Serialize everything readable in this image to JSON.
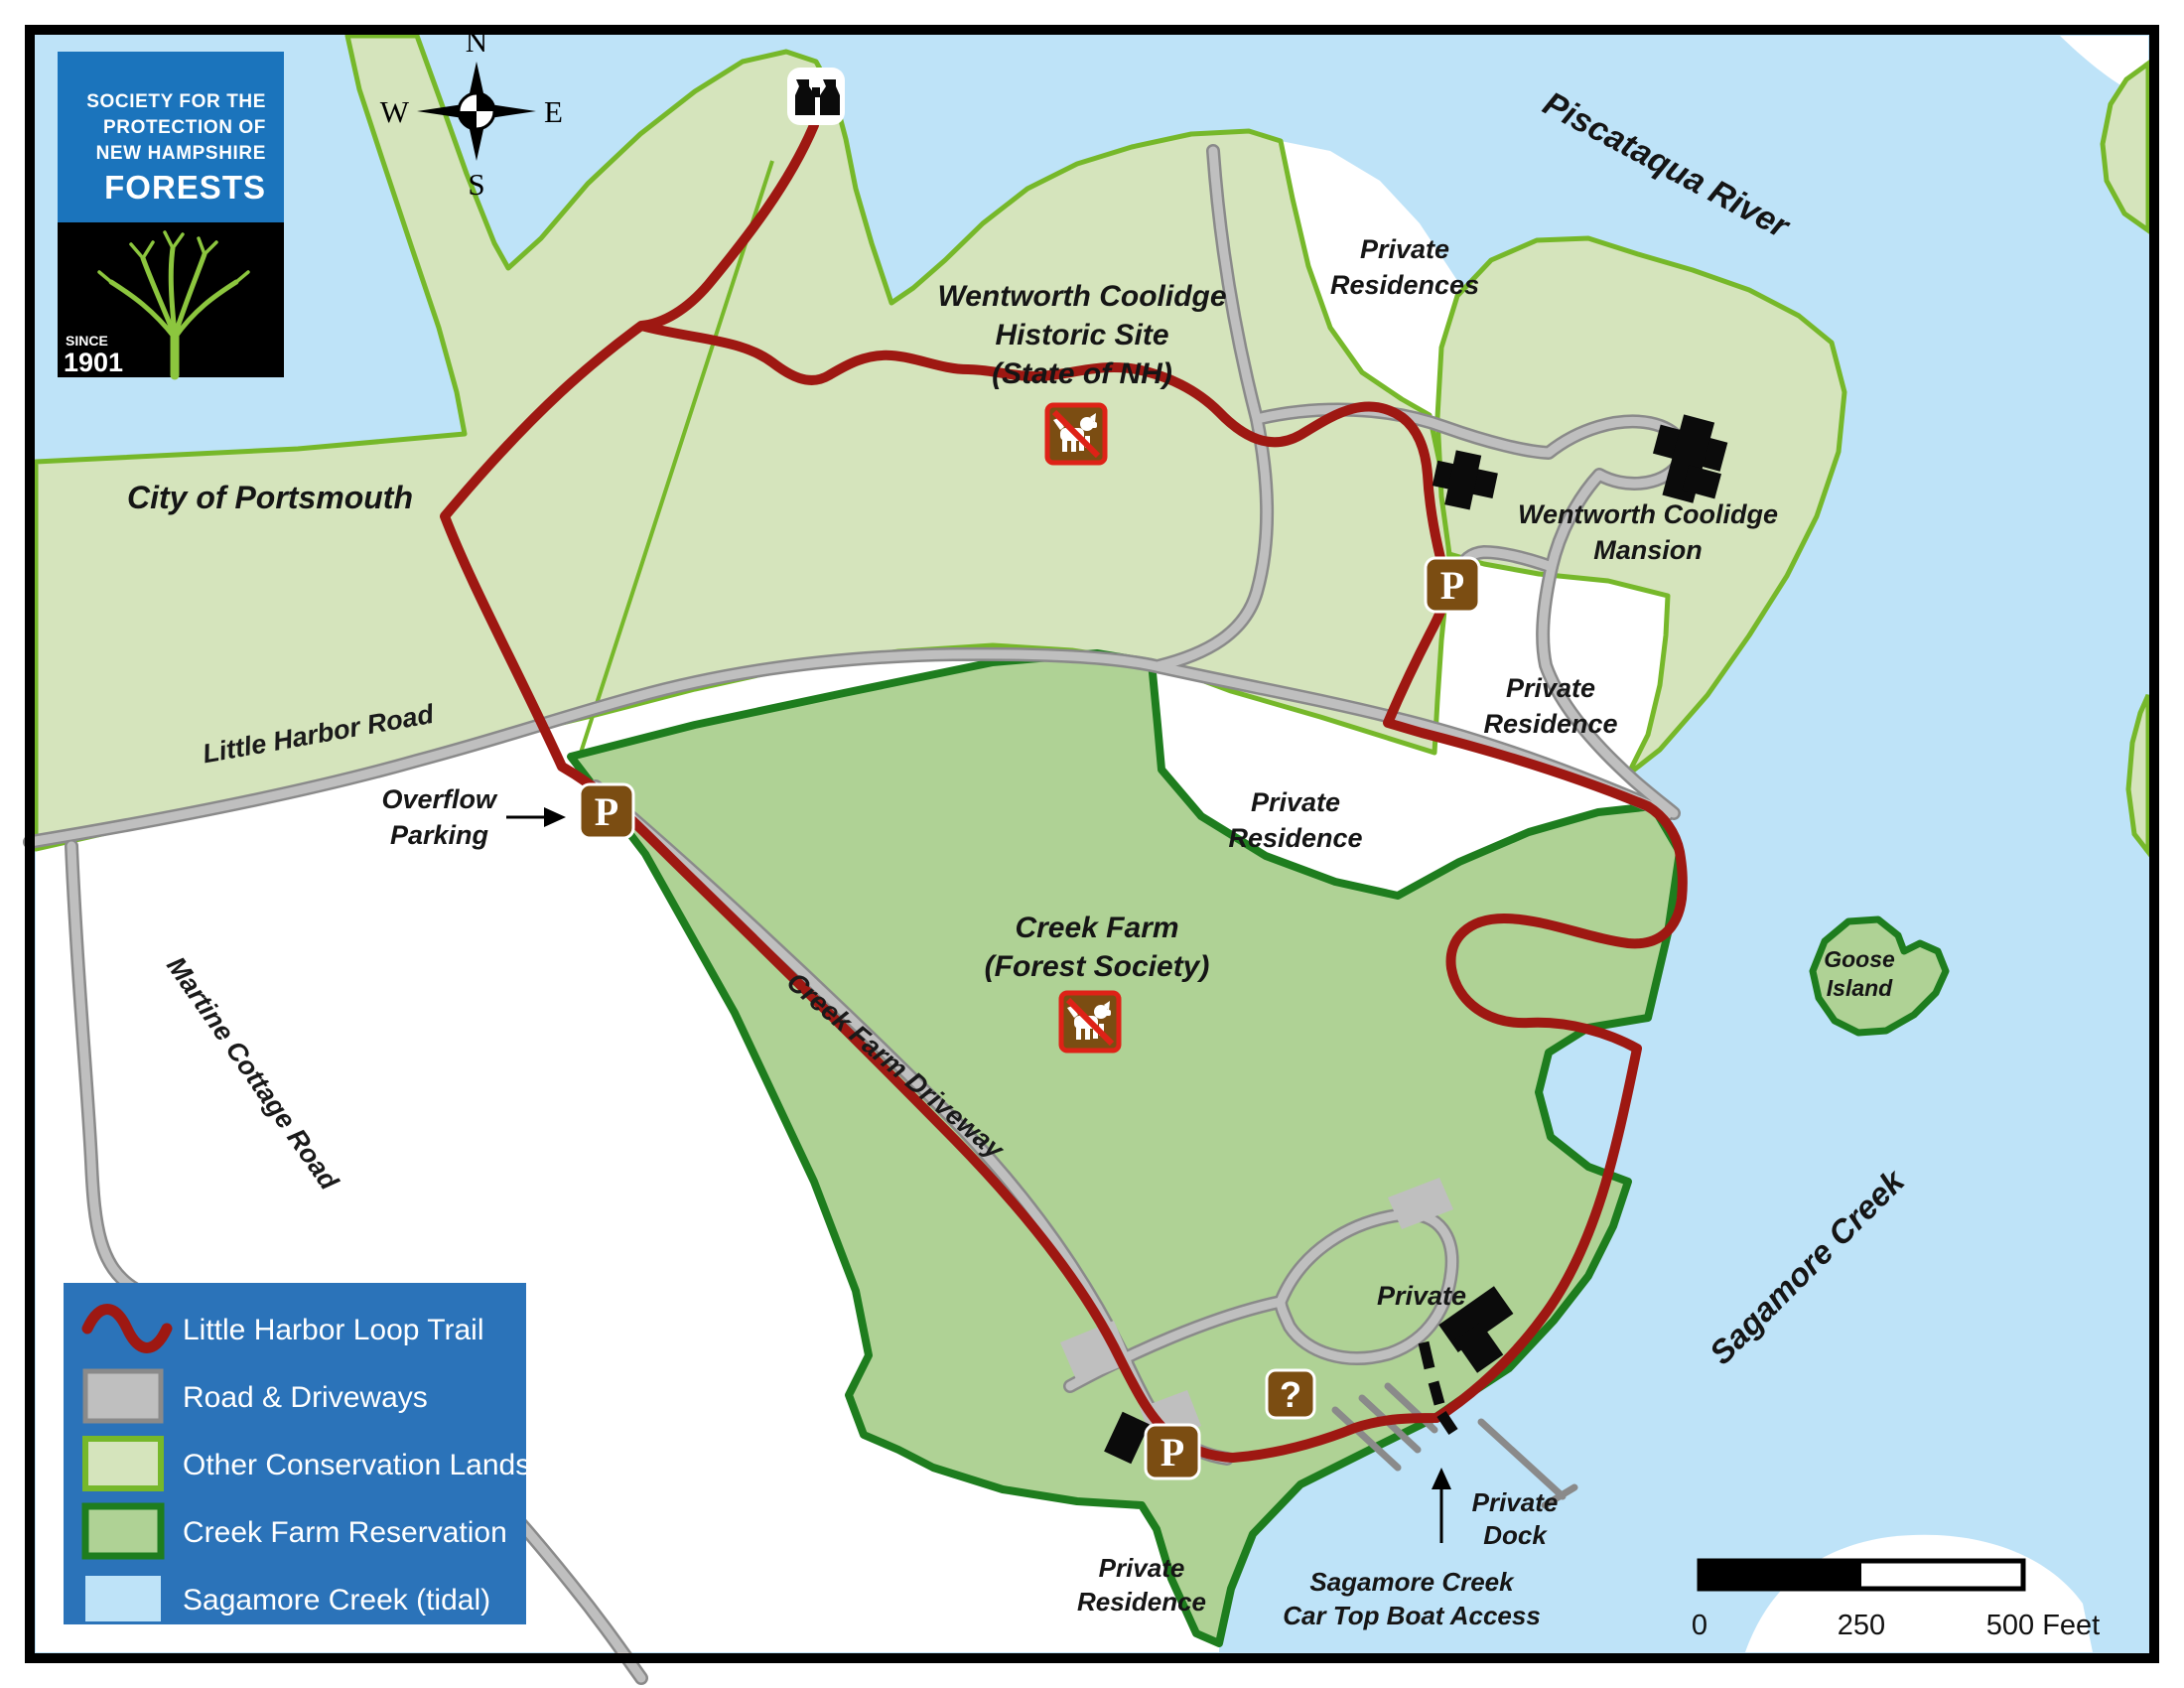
{
  "colors": {
    "water": "#BEE3F8",
    "land_white": "#FFFFFF",
    "conservation_fill": "#D5E4BC",
    "conservation_border": "#76B82A",
    "creek_farm_fill": "#AFD295",
    "creek_farm_border": "#1E7D1E",
    "trail": "#9E1812",
    "road_fill": "#BFBFBF",
    "road_casing": "#8A8A8A",
    "legend_bg": "#2B73B9",
    "icon_brown": "#7B4D12",
    "icon_red": "#DE2217",
    "logo_blue": "#1B74BC",
    "logo_tree_green": "#8CC63E",
    "building_black": "#0B0B0B"
  },
  "logo": {
    "line1": "SOCIETY FOR THE",
    "line2": "PROTECTION OF",
    "line3": "NEW HAMPSHIRE",
    "line4": "FORESTS",
    "since": "SINCE",
    "year": "1901"
  },
  "compass": {
    "n": "N",
    "e": "E",
    "s": "S",
    "w": "W"
  },
  "labels": {
    "piscataqua_river": "Piscataqua River",
    "sagamore_creek": "Sagamore Creek",
    "city_of_portsmouth": "City of Portsmouth",
    "wentworth_site_1": "Wentworth Coolidge",
    "wentworth_site_2": "Historic Site",
    "wentworth_site_3": "(State of NH)",
    "mansion_1": "Wentworth Coolidge",
    "mansion_2": "Mansion",
    "creek_farm_1": "Creek Farm",
    "creek_farm_2": "(Forest Society)",
    "goose_island_1": "Goose",
    "goose_island_2": "Island",
    "private": "Private",
    "residence": "Residence",
    "residences": "Residences",
    "dock": "Dock",
    "little_harbor_road": "Little Harbor Road",
    "martine_cottage_road": "Martine Cottage Road",
    "creek_farm_driveway": "Creek Farm Driveway",
    "overflow_parking_1": "Overflow",
    "overflow_parking_2": "Parking",
    "boat_access_1": "Sagamore Creek",
    "boat_access_2": "Car Top Boat Access"
  },
  "icons": {
    "parking": "P",
    "info": "?"
  },
  "legend": {
    "items": [
      {
        "label": "Little Harbor Loop Trail"
      },
      {
        "label": "Road & Driveways"
      },
      {
        "label": "Other Conservation Lands"
      },
      {
        "label": "Creek Farm Reservation"
      },
      {
        "label": "Sagamore Creek (tidal)"
      }
    ]
  },
  "scale_bar": {
    "t0": "0",
    "t250": "250",
    "t500": "500 Feet"
  }
}
